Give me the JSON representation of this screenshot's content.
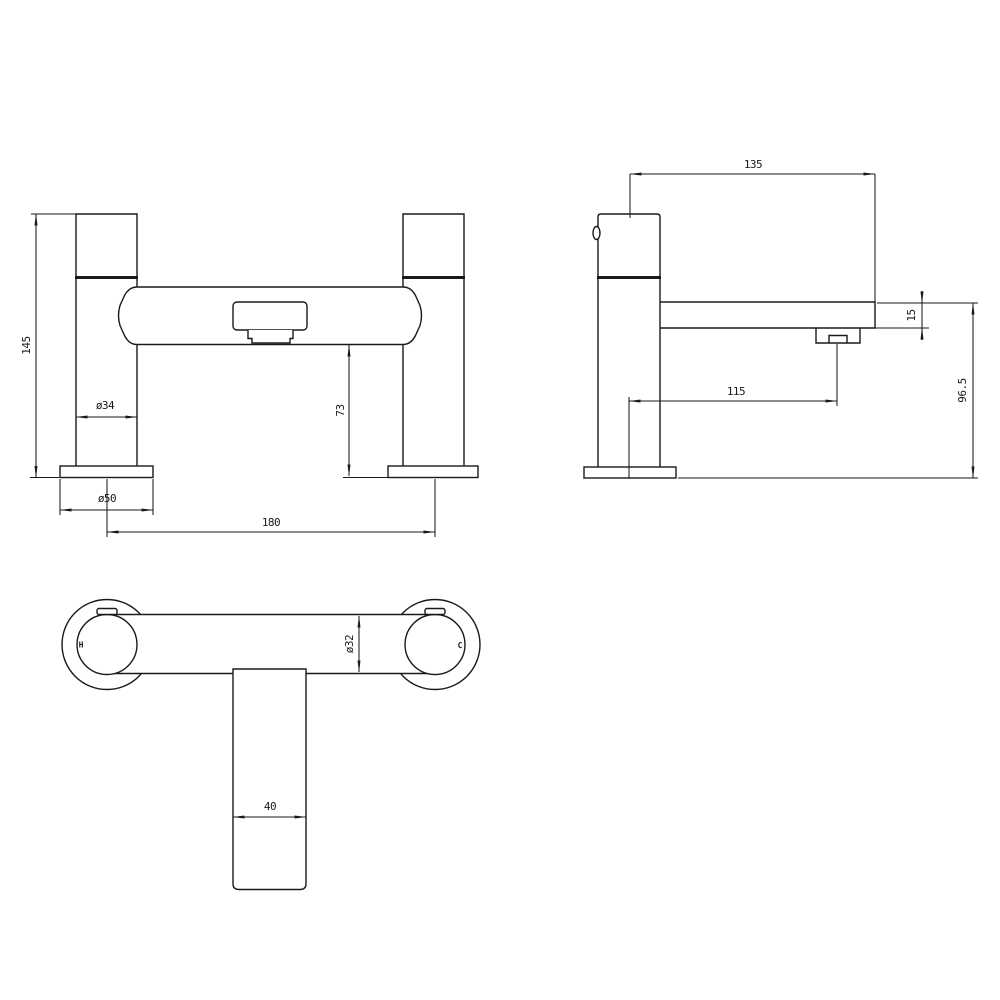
{
  "drawing": {
    "type": "technical-drawing",
    "subject": "bath filler mixer tap - dimensioned orthographic views",
    "colors": {
      "line": "#1a1a1a",
      "background": "#ffffff"
    },
    "views": {
      "front": {
        "name": "front-elevation",
        "dims": {
          "overall_height": "145",
          "pillar_diameter": "ø34",
          "base_diameter": "ø50",
          "spout_clearance": "73",
          "tap_centres": "180"
        }
      },
      "side": {
        "name": "side-elevation",
        "dims": {
          "depth_overall": "135",
          "spout_thickness": "15",
          "spout_projection": "115",
          "height_to_spout": "96.5"
        }
      },
      "plan": {
        "name": "plan-view",
        "hot_indicator": "H",
        "cold_indicator": "C",
        "dims": {
          "body_diameter": "ø32",
          "spout_width": "40"
        }
      }
    }
  }
}
